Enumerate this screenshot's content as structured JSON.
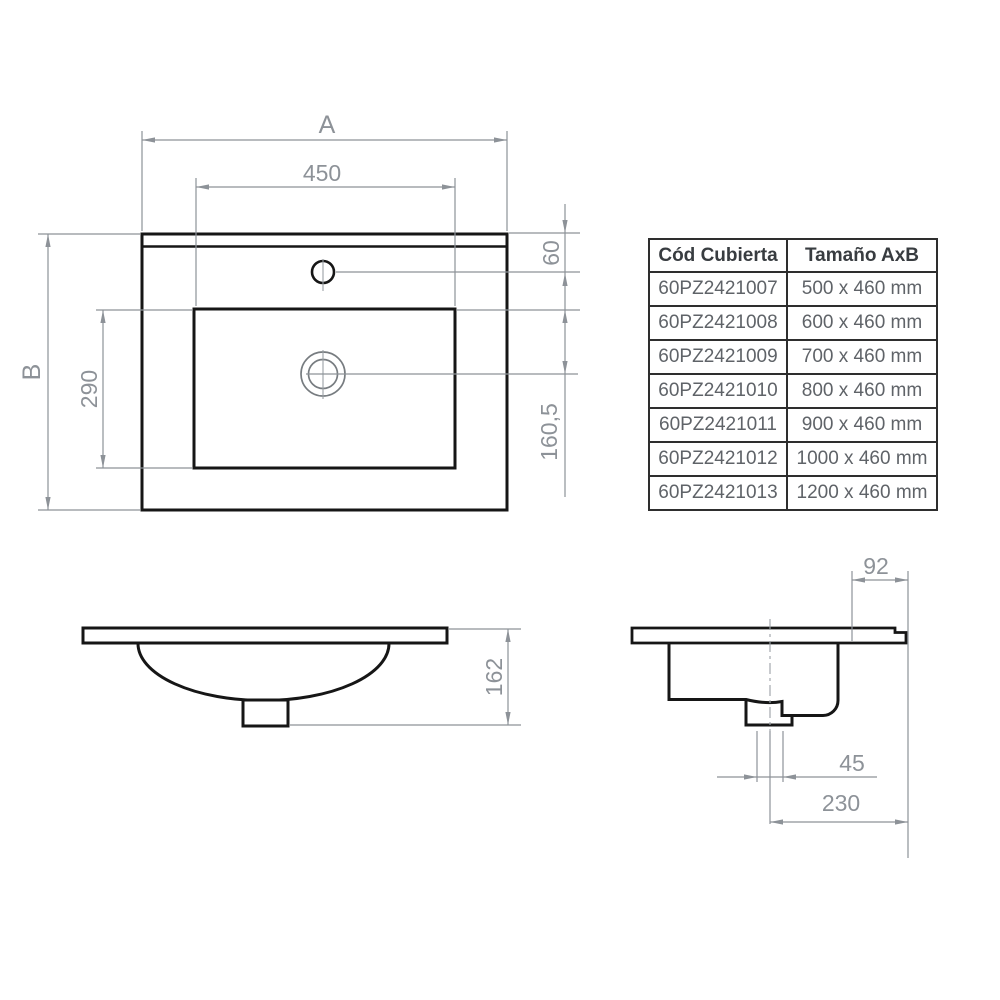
{
  "dims": {
    "plan_width_letter": "A",
    "plan_height_letter": "B",
    "basin_width": "450",
    "basin_depth": "290",
    "faucet_offset": "60",
    "drain_offset": "160,5",
    "front_total_height": "162",
    "side_rear_offset": "92",
    "drain_hole_width": "45",
    "drain_center_offset": "230"
  },
  "table": {
    "headers": [
      "Cód Cubierta",
      "Tamaño AxB"
    ],
    "rows": [
      {
        "code": "60PZ2421007",
        "size": "500 x 460 mm"
      },
      {
        "code": "60PZ2421008",
        "size": "600 x 460 mm"
      },
      {
        "code": "60PZ2421009",
        "size": "700 x 460 mm"
      },
      {
        "code": "60PZ2421010",
        "size": "800 x 460 mm"
      },
      {
        "code": "60PZ2421011",
        "size": "900 x 460 mm"
      },
      {
        "code": "60PZ2421012",
        "size": "1000 x 460 mm"
      },
      {
        "code": "60PZ2421013",
        "size": "1200 x 460 mm"
      }
    ]
  },
  "colors": {
    "object_line": "#161616",
    "dimension_line": "#8d9298",
    "table_border": "#2e2e2e",
    "header_text": "#383c40",
    "cell_text": "#5f6368"
  }
}
